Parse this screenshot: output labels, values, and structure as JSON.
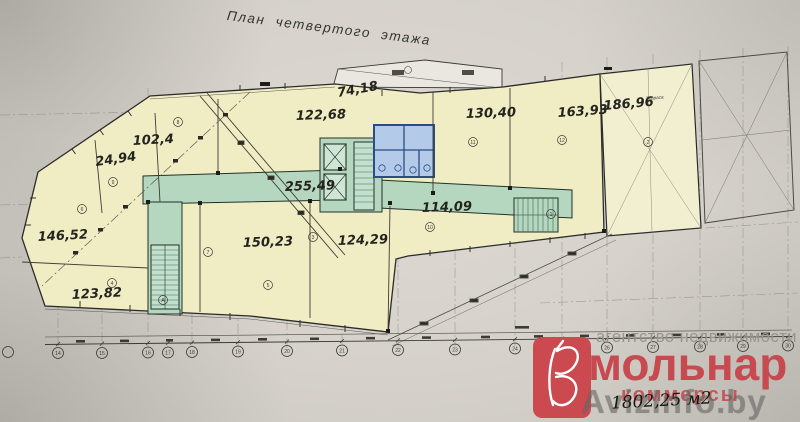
{
  "title": "План четвертого этажа",
  "rooms": {
    "r102": "102,4",
    "r24": "24,94",
    "r122": "122,68",
    "r74": "74,18",
    "r130": "130,40",
    "r163": "163,93",
    "r186": "186,96",
    "corridor": "255,49",
    "r114": "114,09",
    "r146": "146,52",
    "r150": "150,23",
    "r124": "124,29",
    "r123": "123,82"
  },
  "labels": {
    "terrace": "Терраса"
  },
  "branding": {
    "agency_line": "агентство недвижимости",
    "brand_main": "мольнар",
    "brand_sub": "коммерсы",
    "total_area": "1802,25 м2",
    "watermark": "AvizInfo.by"
  },
  "axis_bubbles": {
    "a1": "14",
    "a2": "15",
    "a3": "16",
    "a4": "17",
    "a5": "18",
    "a6": "19",
    "a7": "20",
    "a8": "21",
    "a9": "22",
    "a10": "23",
    "a11": "24",
    "a12": "25",
    "a13": "26",
    "a14": "27",
    "a15": "28",
    "a16": "29",
    "a17": "30"
  },
  "room_bubbles": {
    "k1": "8",
    "k2": "9",
    "k3": "6",
    "k4": "4",
    "k5": "5",
    "k6": "7",
    "k7": "3",
    "k8": "10",
    "k9": "11",
    "k10": "12",
    "k11": "2",
    "k12": "1",
    "k13": "А"
  },
  "colors": {
    "paper": "#d6d2cb",
    "room_fill": "#f0edc5",
    "corridor_fill": "#b5d7bf",
    "wet_block_fill": "#b3cbe9",
    "wet_block_wall": "#2c4c84",
    "brand_red": "#c64a50",
    "line": "#2b2b2b"
  }
}
